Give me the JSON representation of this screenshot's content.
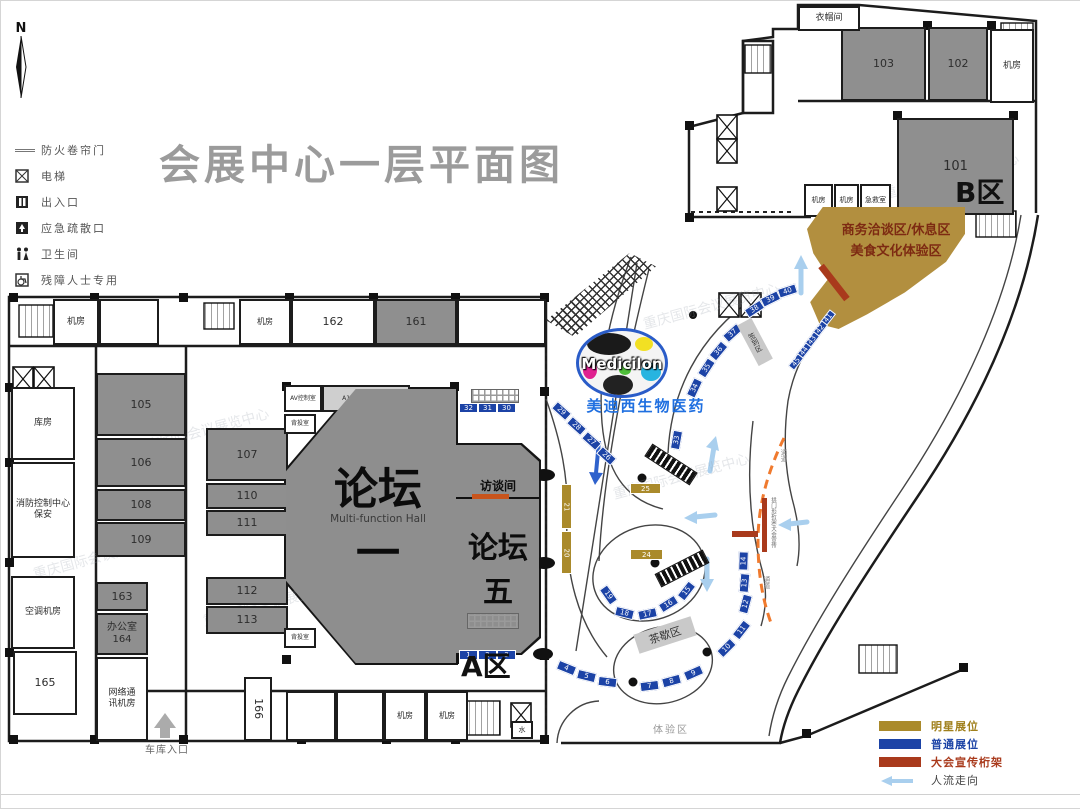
{
  "title": "会展中心一层平面图",
  "compass": "N",
  "watermark_text": "重庆国际会议展览中心",
  "legend_top": {
    "items": [
      {
        "icon": "fire-shutter-icon",
        "label": "防火卷帘门"
      },
      {
        "icon": "elevator-icon",
        "label": "电梯"
      },
      {
        "icon": "entrance-icon",
        "label": "出入口"
      },
      {
        "icon": "emergency-exit-icon",
        "label": "应急疏散口"
      },
      {
        "icon": "restroom-icon",
        "label": "卫生间"
      },
      {
        "icon": "accessible-icon",
        "label": "残障人士专用"
      }
    ]
  },
  "legend_bottom": {
    "items": [
      {
        "label": "明星展位",
        "color": "#aa8a2b",
        "text_color": "#a0801c"
      },
      {
        "label": "普通展位",
        "color": "#1c43a6",
        "text_color": "#1c43a6"
      },
      {
        "label": "大会宣传桁架",
        "color": "#a93a1c",
        "text_color": "#a93a1c"
      },
      {
        "label": "人流走向",
        "color": "arrow",
        "text_color": "#444444"
      }
    ]
  },
  "halls": {
    "forum1": {
      "name": "论坛一",
      "subtitle": "Multi-function Hall"
    },
    "forum5": {
      "name": "论坛五"
    },
    "interview": {
      "name": "访谈间"
    }
  },
  "zones": {
    "zone_a": "A区",
    "zone_b": "B区",
    "business_line1": "商务洽谈区/休息区",
    "business_line2": "美食文化体验区",
    "sign_in": "签到区",
    "tea_break": "茶歇区",
    "experience": "体验区",
    "garage": "车库入口",
    "passage": "通道",
    "truss_note": "拱门形桁架/大会宣传"
  },
  "brand": {
    "logo": "Medicilon",
    "name": "美迪西生物医药"
  },
  "rooms": [
    {
      "label": "103",
      "x": 840,
      "y": 26,
      "w": 85,
      "h": 74,
      "fill": "#8f8f8f"
    },
    {
      "label": "102",
      "x": 927,
      "y": 26,
      "w": 60,
      "h": 74,
      "fill": "#8f8f8f"
    },
    {
      "label": "机房",
      "x": 989,
      "y": 28,
      "w": 44,
      "h": 74,
      "fill": "#ffffff",
      "fs": 9
    },
    {
      "label": "衣帽间",
      "x": 797,
      "y": 5,
      "w": 62,
      "h": 25,
      "fill": "#ffffff",
      "fs": 9
    },
    {
      "label": "101",
      "x": 896,
      "y": 117,
      "w": 117,
      "h": 97,
      "fill": "#8f8f8f",
      "fs": 13
    },
    {
      "label": "机房",
      "x": 803,
      "y": 183,
      "w": 29,
      "h": 33,
      "fill": "#ffffff",
      "fs": 7
    },
    {
      "label": "机房",
      "x": 833,
      "y": 183,
      "w": 25,
      "h": 33,
      "fill": "#ffffff",
      "fs": 7
    },
    {
      "label": "急救室",
      "x": 859,
      "y": 183,
      "w": 31,
      "h": 33,
      "fill": "#ffffff",
      "fs": 7
    },
    {
      "label": "机房",
      "x": 52,
      "y": 298,
      "w": 46,
      "h": 46,
      "fill": "#ffffff",
      "fs": 9
    },
    {
      "label": "",
      "x": 98,
      "y": 298,
      "w": 60,
      "h": 46,
      "fill": "#ffffff"
    },
    {
      "label": "机房",
      "x": 238,
      "y": 298,
      "w": 52,
      "h": 46,
      "fill": "#ffffff",
      "fs": 8
    },
    {
      "label": "162",
      "x": 290,
      "y": 298,
      "w": 84,
      "h": 46,
      "fill": "#ffffff"
    },
    {
      "label": "161",
      "x": 374,
      "y": 298,
      "w": 82,
      "h": 46,
      "fill": "#8f8f8f"
    },
    {
      "label": "",
      "x": 456,
      "y": 298,
      "w": 89,
      "h": 46,
      "fill": "#ffffff"
    },
    {
      "label": "库房",
      "x": 10,
      "y": 386,
      "w": 64,
      "h": 73,
      "fill": "#ffffff",
      "fs": 9
    },
    {
      "label": "消防控制中心\n保安",
      "x": 10,
      "y": 461,
      "w": 64,
      "h": 96,
      "fill": "#ffffff",
      "fs": 9
    },
    {
      "label": "空调机房",
      "x": 10,
      "y": 575,
      "w": 64,
      "h": 73,
      "fill": "#ffffff",
      "fs": 9
    },
    {
      "label": "165",
      "x": 12,
      "y": 650,
      "w": 64,
      "h": 64,
      "fill": "#ffffff"
    },
    {
      "label": "105",
      "x": 95,
      "y": 372,
      "w": 90,
      "h": 63,
      "fill": "#8f8f8f"
    },
    {
      "label": "106",
      "x": 95,
      "y": 437,
      "w": 90,
      "h": 49,
      "fill": "#8f8f8f"
    },
    {
      "label": "108",
      "x": 95,
      "y": 488,
      "w": 90,
      "h": 32,
      "fill": "#8f8f8f"
    },
    {
      "label": "109",
      "x": 95,
      "y": 521,
      "w": 90,
      "h": 35,
      "fill": "#8f8f8f"
    },
    {
      "label": "107",
      "x": 205,
      "y": 427,
      "w": 82,
      "h": 53,
      "fill": "#8f8f8f"
    },
    {
      "label": "110",
      "x": 205,
      "y": 482,
      "w": 82,
      "h": 26,
      "fill": "#8f8f8f"
    },
    {
      "label": "111",
      "x": 205,
      "y": 509,
      "w": 82,
      "h": 26,
      "fill": "#8f8f8f"
    },
    {
      "label": "112",
      "x": 205,
      "y": 576,
      "w": 82,
      "h": 28,
      "fill": "#8f8f8f"
    },
    {
      "label": "113",
      "x": 205,
      "y": 605,
      "w": 82,
      "h": 28,
      "fill": "#8f8f8f"
    },
    {
      "label": "163",
      "x": 95,
      "y": 581,
      "w": 52,
      "h": 29,
      "fill": "#8f8f8f"
    },
    {
      "label": "办公室\n164",
      "x": 95,
      "y": 612,
      "w": 52,
      "h": 42,
      "fill": "#8f8f8f",
      "fs": 10
    },
    {
      "label": "网络通\n讯机房",
      "x": 95,
      "y": 656,
      "w": 52,
      "h": 84,
      "fill": "#ffffff",
      "fs": 9
    },
    {
      "label": "166",
      "x": 243,
      "y": 676,
      "w": 28,
      "h": 64,
      "fill": "#ffffff",
      "tr": 90
    },
    {
      "label": "",
      "x": 285,
      "y": 690,
      "w": 50,
      "h": 50,
      "fill": "#ffffff"
    },
    {
      "label": "",
      "x": 335,
      "y": 690,
      "w": 48,
      "h": 50,
      "fill": "#ffffff"
    },
    {
      "label": "机房",
      "x": 383,
      "y": 690,
      "w": 42,
      "h": 50,
      "fill": "#ffffff",
      "fs": 8
    },
    {
      "label": "机房",
      "x": 425,
      "y": 690,
      "w": 42,
      "h": 50,
      "fill": "#ffffff",
      "fs": 8
    },
    {
      "label": "AV控制室",
      "x": 283,
      "y": 384,
      "w": 38,
      "h": 27,
      "fill": "#ffffff",
      "fs": 6
    },
    {
      "label": "A1-19同声传译室",
      "x": 321,
      "y": 384,
      "w": 88,
      "h": 27,
      "fill": "#cfcfcf",
      "fs": 6
    },
    {
      "label": "背投室",
      "x": 283,
      "y": 413,
      "w": 32,
      "h": 20,
      "fill": "#ffffff",
      "fs": 6
    },
    {
      "label": "背投室",
      "x": 283,
      "y": 627,
      "w": 32,
      "h": 20,
      "fill": "#ffffff",
      "fs": 6
    },
    {
      "label": "水",
      "x": 510,
      "y": 720,
      "w": 22,
      "h": 18,
      "fill": "#ffffff",
      "fs": 7
    }
  ],
  "booths": {
    "blue": [
      {
        "n": "1",
        "x": 458,
        "y": 649
      },
      {
        "n": "2",
        "x": 477,
        "y": 649
      },
      {
        "n": "3",
        "x": 496,
        "y": 649
      },
      {
        "n": "4",
        "x": 556,
        "y": 662,
        "r": 22
      },
      {
        "n": "5",
        "x": 576,
        "y": 670,
        "r": 14
      },
      {
        "n": "6",
        "x": 597,
        "y": 676,
        "r": 7
      },
      {
        "n": "7",
        "x": 639,
        "y": 680,
        "r": -7
      },
      {
        "n": "8",
        "x": 661,
        "y": 675,
        "r": -15
      },
      {
        "n": "9",
        "x": 683,
        "y": 667,
        "r": -24
      },
      {
        "n": "10",
        "x": 716,
        "y": 642,
        "r": -45
      },
      {
        "n": "11",
        "x": 731,
        "y": 624,
        "r": -52
      },
      {
        "n": "12",
        "x": 735,
        "y": 598,
        "r": -75
      },
      {
        "n": "13",
        "x": 734,
        "y": 577,
        "r": -85
      },
      {
        "n": "14",
        "x": 733,
        "y": 555,
        "r": -88
      },
      {
        "n": "15",
        "x": 676,
        "y": 585,
        "r": -52
      },
      {
        "n": "16",
        "x": 658,
        "y": 598,
        "r": -32
      },
      {
        "n": "17",
        "x": 637,
        "y": 608,
        "r": -12
      },
      {
        "n": "18",
        "x": 614,
        "y": 607,
        "r": 14
      },
      {
        "n": "19",
        "x": 598,
        "y": 589,
        "r": 55
      },
      {
        "n": "26",
        "x": 596,
        "y": 450,
        "r": 42
      },
      {
        "n": "27",
        "x": 581,
        "y": 435,
        "r": 42
      },
      {
        "n": "28",
        "x": 566,
        "y": 420,
        "r": 42
      },
      {
        "n": "29",
        "x": 551,
        "y": 405,
        "r": 42
      },
      {
        "n": "30",
        "x": 496,
        "y": 402
      },
      {
        "n": "31",
        "x": 477,
        "y": 402
      },
      {
        "n": "32",
        "x": 458,
        "y": 402
      },
      {
        "n": "33",
        "x": 666,
        "y": 434,
        "r": -80
      },
      {
        "n": "34",
        "x": 684,
        "y": 382,
        "r": -65
      },
      {
        "n": "35",
        "x": 696,
        "y": 362,
        "r": -57
      },
      {
        "n": "36",
        "x": 708,
        "y": 345,
        "r": -50
      },
      {
        "n": "37",
        "x": 722,
        "y": 327,
        "r": -42
      },
      {
        "n": "38",
        "x": 744,
        "y": 303,
        "r": -33
      },
      {
        "n": "39",
        "x": 760,
        "y": 293,
        "r": -26
      },
      {
        "n": "40",
        "x": 777,
        "y": 285,
        "r": -18
      },
      {
        "n": "41",
        "x": 819,
        "y": 313,
        "r": -52,
        "w": 16,
        "h": 8
      },
      {
        "n": "42",
        "x": 811,
        "y": 324,
        "r": -52,
        "w": 16,
        "h": 8
      },
      {
        "n": "43",
        "x": 803,
        "y": 335,
        "r": -52,
        "w": 16,
        "h": 8
      },
      {
        "n": "44",
        "x": 795,
        "y": 346,
        "r": -52,
        "w": 16,
        "h": 8
      },
      {
        "n": "45",
        "x": 787,
        "y": 357,
        "r": -52,
        "w": 16,
        "h": 8
      }
    ],
    "tan": [
      {
        "n": "21",
        "x": 560,
        "y": 483,
        "w": 11,
        "h": 45,
        "tr": 90
      },
      {
        "n": "20",
        "x": 560,
        "y": 530,
        "w": 11,
        "h": 43,
        "tr": 90
      },
      {
        "n": "25",
        "x": 629,
        "y": 482,
        "w": 31,
        "h": 11
      },
      {
        "n": "24",
        "x": 629,
        "y": 548,
        "w": 33,
        "h": 11
      }
    ]
  },
  "trusses": [
    {
      "x": 812,
      "y": 278,
      "w": 42,
      "h": 7,
      "r": 52
    },
    {
      "x": 731,
      "y": 530,
      "w": 26,
      "h": 6
    },
    {
      "x": 761,
      "y": 497,
      "w": 5,
      "h": 54
    },
    {
      "x": 471,
      "y": 493,
      "w": 37,
      "h": 5,
      "fill": "#c8541c"
    }
  ],
  "watermarks": [
    {
      "t": "重庆国际会议展览中心",
      "x": 130,
      "y": 420
    },
    {
      "t": "重庆国际会议展览中心",
      "x": 30,
      "y": 545
    },
    {
      "t": "重庆国际会议展览中心",
      "x": 200,
      "y": 592
    },
    {
      "t": "重庆国际会议展览中心",
      "x": 640,
      "y": 295
    },
    {
      "t": "重庆国际会议展览中心",
      "x": 880,
      "y": 165
    },
    {
      "t": "重庆国际会议展览中心",
      "x": 610,
      "y": 465
    }
  ]
}
